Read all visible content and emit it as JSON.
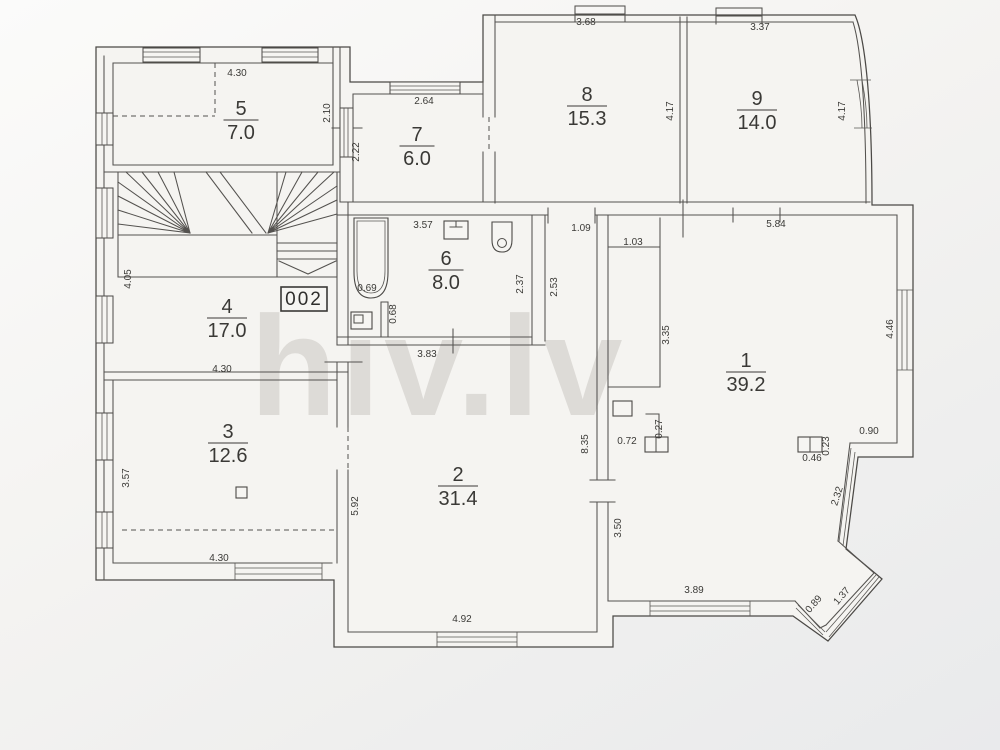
{
  "watermark": "hiv.lv",
  "unit_label": "002",
  "colors": {
    "paper": "#f5f4f1",
    "line": "#4b4946",
    "text": "#3a3936",
    "watermark": "#d8d5d1"
  },
  "rooms": [
    {
      "number": "1",
      "area": "39.2",
      "x": 746,
      "y": 372
    },
    {
      "number": "2",
      "area": "31.4",
      "x": 458,
      "y": 486
    },
    {
      "number": "3",
      "area": "12.6",
      "x": 228,
      "y": 443
    },
    {
      "number": "4",
      "area": "17.0",
      "x": 227,
      "y": 318
    },
    {
      "number": "5",
      "area": "7.0",
      "x": 241,
      "y": 120
    },
    {
      "number": "6",
      "area": "8.0",
      "x": 446,
      "y": 270
    },
    {
      "number": "7",
      "area": "6.0",
      "x": 417,
      "y": 146
    },
    {
      "number": "8",
      "area": "15.3",
      "x": 587,
      "y": 106
    },
    {
      "number": "9",
      "area": "14.0",
      "x": 757,
      "y": 110
    }
  ],
  "dimensions": [
    {
      "text": "4.30",
      "x": 237,
      "y": 76,
      "rot": 0
    },
    {
      "text": "2.10",
      "x": 330,
      "y": 113,
      "rot": -90
    },
    {
      "text": "2.22",
      "x": 359,
      "y": 152,
      "rot": -90
    },
    {
      "text": "2.64",
      "x": 424,
      "y": 104,
      "rot": 0
    },
    {
      "text": "3.68",
      "x": 586,
      "y": 25,
      "rot": 0
    },
    {
      "text": "3.37",
      "x": 760,
      "y": 30,
      "rot": 0
    },
    {
      "text": "4.17",
      "x": 673,
      "y": 111,
      "rot": -90
    },
    {
      "text": "4.17",
      "x": 845,
      "y": 111,
      "rot": -90
    },
    {
      "text": "3.57",
      "x": 423,
      "y": 228,
      "rot": 0
    },
    {
      "text": "1.09",
      "x": 581,
      "y": 231,
      "rot": 0
    },
    {
      "text": "1.03",
      "x": 633,
      "y": 245,
      "rot": 0
    },
    {
      "text": "5.84",
      "x": 776,
      "y": 227,
      "rot": 0
    },
    {
      "text": "4.05",
      "x": 131,
      "y": 279,
      "rot": -90
    },
    {
      "text": "0.69",
      "x": 367,
      "y": 291,
      "rot": 0
    },
    {
      "text": "0.68",
      "x": 396,
      "y": 314,
      "rot": -90
    },
    {
      "text": "2.37",
      "x": 523,
      "y": 284,
      "rot": -90
    },
    {
      "text": "2.53",
      "x": 557,
      "y": 287,
      "rot": -90
    },
    {
      "text": "3.35",
      "x": 669,
      "y": 335,
      "rot": -90
    },
    {
      "text": "4.46",
      "x": 893,
      "y": 329,
      "rot": -90
    },
    {
      "text": "3.83",
      "x": 427,
      "y": 357,
      "rot": 0
    },
    {
      "text": "4.30",
      "x": 222,
      "y": 372,
      "rot": 0
    },
    {
      "text": "8.35",
      "x": 588,
      "y": 444,
      "rot": -90
    },
    {
      "text": "0.27",
      "x": 662,
      "y": 429,
      "rot": -90
    },
    {
      "text": "0.72",
      "x": 627,
      "y": 444,
      "rot": 0
    },
    {
      "text": "0.23",
      "x": 829,
      "y": 446,
      "rot": -90
    },
    {
      "text": "0.46",
      "x": 812,
      "y": 461,
      "rot": 0
    },
    {
      "text": "0.90",
      "x": 869,
      "y": 434,
      "rot": 0
    },
    {
      "text": "2.32",
      "x": 840,
      "y": 497,
      "rot": -73
    },
    {
      "text": "3.57",
      "x": 129,
      "y": 478,
      "rot": -90
    },
    {
      "text": "5.92",
      "x": 358,
      "y": 506,
      "rot": -90
    },
    {
      "text": "3.50",
      "x": 621,
      "y": 528,
      "rot": -90
    },
    {
      "text": "4.30",
      "x": 219,
      "y": 561,
      "rot": 0
    },
    {
      "text": "4.92",
      "x": 462,
      "y": 622,
      "rot": 0
    },
    {
      "text": "3.89",
      "x": 694,
      "y": 593,
      "rot": 0
    },
    {
      "text": "0.89",
      "x": 816,
      "y": 606,
      "rot": -49
    },
    {
      "text": "1.37",
      "x": 844,
      "y": 598,
      "rot": -49
    }
  ]
}
